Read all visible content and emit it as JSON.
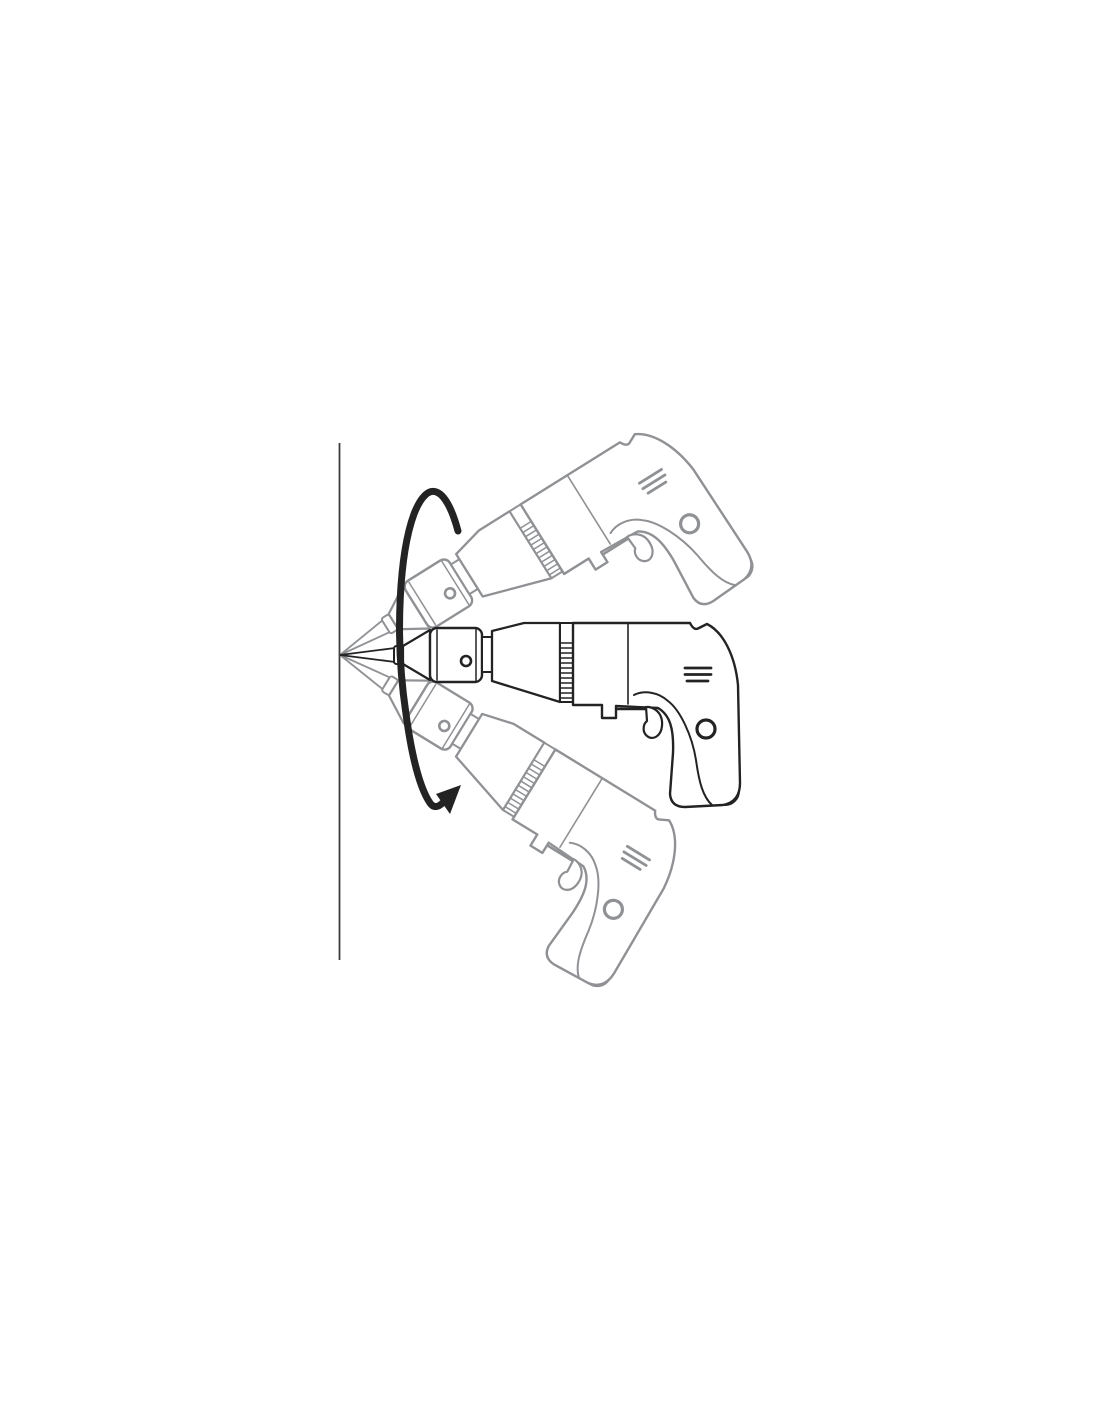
{
  "figure": {
    "kind": "instruction-manual-line-art",
    "background_color": "#ffffff",
    "ink_color": "#232323",
    "ghost_color": "#8f9194",
    "wall_color": "#3d3d3d",
    "elements": {
      "wall": "wall-edge",
      "drill_center": "drill-perpendicular-icon",
      "drill_upper": "drill-tilted-up-icon",
      "drill_lower": "drill-tilted-down-icon",
      "rotation_arrow": "rotation-sweep-arrow-icon"
    }
  }
}
